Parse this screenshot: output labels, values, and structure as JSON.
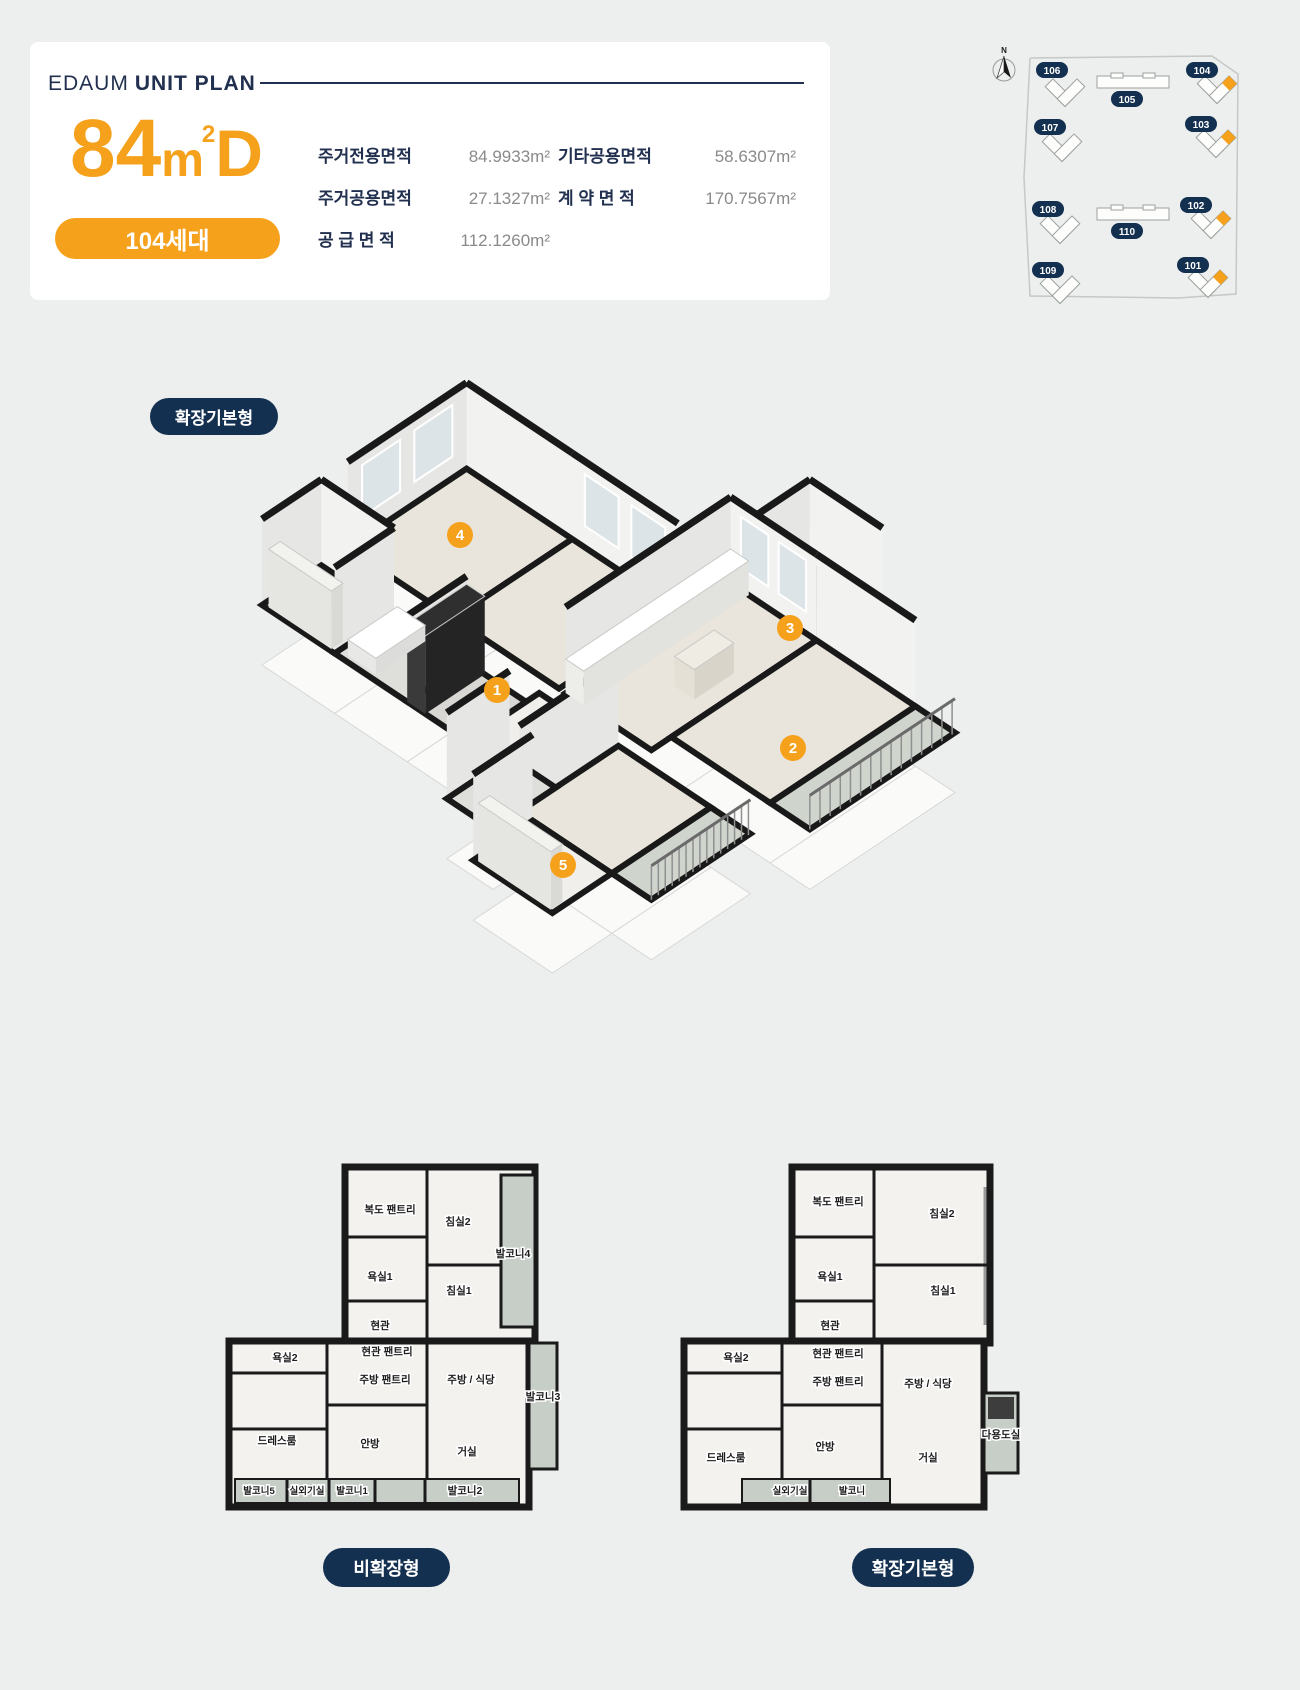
{
  "colors": {
    "orange": "#F5A11C",
    "navy": "#223050",
    "badge_navy": "#143050",
    "background": "#EDEFEE",
    "card": "#FFFFFF",
    "value_gray": "#8A8A8A",
    "wall_black": "#1A1A1A",
    "plan_floor": "#F3F2EF",
    "plan_balcony": "#C7CEC7"
  },
  "header": {
    "brand": "EDAUM",
    "title": "UNIT PLAN",
    "type_number": "84",
    "type_unit": "m",
    "type_sup": "2",
    "type_letter": "D",
    "units_badge": "104세대"
  },
  "specs": {
    "col1": [
      {
        "label": "주거전용면적",
        "value": "84.9933m²"
      },
      {
        "label": "주거공용면적",
        "value": "27.1327m²"
      },
      {
        "label": "공 급 면 적",
        "value": "112.1260m²"
      }
    ],
    "col2": [
      {
        "label": "기타공용면적",
        "value": "58.6307m²"
      },
      {
        "label": "계 약 면 적",
        "value": "170.7567m²"
      }
    ]
  },
  "site_map": {
    "north_label": "N",
    "highlighted_buildings": [
      "101",
      "102",
      "103",
      "104"
    ],
    "buildings": [
      {
        "id": "106",
        "type": "tower",
        "bx": 135,
        "by": 52,
        "lx": 122,
        "ly": 24,
        "hl": false
      },
      {
        "id": "105",
        "type": "slab",
        "bx": 203,
        "by": 36,
        "lx": 197,
        "ly": 53,
        "hl": false
      },
      {
        "id": "104",
        "type": "tower",
        "bx": 287,
        "by": 49,
        "lx": 272,
        "ly": 24,
        "hl": true
      },
      {
        "id": "107",
        "type": "tower",
        "bx": 132,
        "by": 107,
        "lx": 120,
        "ly": 81,
        "hl": false
      },
      {
        "id": "103",
        "type": "tower",
        "bx": 286,
        "by": 103,
        "lx": 271,
        "ly": 78,
        "hl": true
      },
      {
        "id": "108",
        "type": "tower",
        "bx": 130,
        "by": 189,
        "lx": 118,
        "ly": 163,
        "hl": false
      },
      {
        "id": "110",
        "type": "slab",
        "bx": 203,
        "by": 168,
        "lx": 197,
        "ly": 185,
        "hl": false
      },
      {
        "id": "102",
        "type": "tower",
        "bx": 281,
        "by": 184,
        "lx": 266,
        "ly": 159,
        "hl": true
      },
      {
        "id": "109",
        "type": "tower",
        "bx": 130,
        "by": 249,
        "lx": 118,
        "ly": 224,
        "hl": false
      },
      {
        "id": "101",
        "type": "tower",
        "bx": 278,
        "by": 243,
        "lx": 263,
        "ly": 219,
        "hl": true
      }
    ]
  },
  "iso": {
    "badge": "확장기본형",
    "cfg": {
      "x0": 17,
      "y0": 245,
      "w": 33,
      "h": 22,
      "wallH": 86,
      "platform": 60
    },
    "rooms": [
      {
        "id": "bedroom2",
        "u1": 2.6,
        "v1": 0,
        "u2": 6.2,
        "v2": 3.2,
        "fc": "#e9e5dc",
        "walls": "ne",
        "win": [
          "n"
        ]
      },
      {
        "id": "bedroom1",
        "u1": 2.6,
        "v1": 3.2,
        "u2": 6.2,
        "v2": 6.4,
        "fc": "#e9e5dc",
        "walls": "e",
        "win": [
          "e"
        ]
      },
      {
        "id": "pantry-hall",
        "u1": 0,
        "v1": 0,
        "u2": 1.8,
        "v2": 2.2,
        "fc": "#f0efeb",
        "walls": "ne"
      },
      {
        "id": "utility",
        "u1": 7.6,
        "v1": 7.4,
        "u2": 9.2,
        "v2": 9.6,
        "fc": "#4c4c4a",
        "walls": "ne"
      },
      {
        "id": "kitchen",
        "u1": 2.6,
        "v1": 6.6,
        "u2": 7.6,
        "v2": 9.2,
        "fc": "#e9e5dc",
        "walls": "ne",
        "win": [
          "e"
        ]
      },
      {
        "id": "bathroom1",
        "u1": 0,
        "v1": 2.2,
        "u2": 1.8,
        "v2": 4.4,
        "fc": "#dededb",
        "walls": "n"
      },
      {
        "id": "living",
        "u1": 3.2,
        "v1": 9.2,
        "u2": 7.6,
        "v2": 12.2,
        "fc": "#e9e5dc",
        "walls": "e"
      },
      {
        "id": "entry",
        "u1": 0,
        "v1": 4.4,
        "u2": 1.8,
        "v2": 6.2,
        "fc": "#d9d7d3",
        "walls": "n"
      },
      {
        "id": "hallway",
        "u1": 0.3,
        "v1": 6.2,
        "u2": 2.2,
        "v2": 8.4,
        "fc": "#f0efeb",
        "walls": ""
      },
      {
        "id": "balcony",
        "u1": 3.2,
        "v1": 12.2,
        "u2": 7.6,
        "v2": 13.4,
        "fc": "#cfd4cd",
        "walls": "",
        "rail": true
      },
      {
        "id": "master",
        "u1": -0.8,
        "v1": 8.6,
        "u2": 2.2,
        "v2": 11.4,
        "fc": "#e9e5dc",
        "walls": "n"
      },
      {
        "id": "bathroom2",
        "u1": -1.6,
        "v1": 7.2,
        "u2": 0.3,
        "v2": 8.6,
        "fc": "#dededb",
        "walls": "n"
      },
      {
        "id": "outdoor-unit",
        "u1": -0.8,
        "v1": 11.4,
        "u2": 2.2,
        "v2": 12.6,
        "fc": "#cfd4cd",
        "walls": "",
        "rail": true
      },
      {
        "id": "dressroom",
        "u1": -2.6,
        "v1": 9,
        "u2": -0.8,
        "v2": 11.4,
        "fc": "#f0efeb",
        "walls": "n"
      }
    ],
    "boxes": [
      {
        "u1": 0,
        "v1": 4.4,
        "u2": 1.8,
        "v2": 4.95,
        "h": 78,
        "f": "#2f2f2f",
        "s1": "#242424",
        "s2": "#3a3a3a"
      },
      {
        "u1": 2.6,
        "v1": 6.6,
        "u2": 7.6,
        "v2": 7.15,
        "h": 34,
        "f": "#ffffff",
        "s1": "#e2e2df",
        "s2": "#ededea"
      },
      {
        "u1": 4.4,
        "v1": 8.1,
        "u2": 5.6,
        "v2": 8.7,
        "h": 30,
        "f": "#efece4",
        "s1": "#d8d4c9",
        "s2": "#e4e0d6"
      },
      {
        "u1": 0.15,
        "v1": 2.45,
        "u2": 1.65,
        "v2": 3.3,
        "h": 16,
        "f": "#ffffff",
        "s1": "#dcdcda",
        "s2": "#e8e8e6"
      },
      {
        "u1": 0.05,
        "v1": 0.15,
        "u2": 0.4,
        "v2": 2.05,
        "h": 58,
        "f": "#f2f2ef",
        "s1": "#d9d9d6",
        "s2": "#e5e5e2"
      },
      {
        "u1": -2.55,
        "v1": 9.1,
        "u2": -2.2,
        "v2": 11.3,
        "h": 58,
        "f": "#f2f2ef",
        "s1": "#d9d9d6",
        "s2": "#e5e5e2"
      }
    ],
    "markers": [
      {
        "n": "1",
        "x": 252,
        "y": 330
      },
      {
        "n": "2",
        "x": 548,
        "y": 388
      },
      {
        "n": "3",
        "x": 545,
        "y": 268
      },
      {
        "n": "4",
        "x": 215,
        "y": 175
      },
      {
        "n": "5",
        "x": 318,
        "y": 505
      }
    ]
  },
  "plans": [
    {
      "name": "비확장형",
      "labels": [
        {
          "t": "복도 팬트리",
          "x": 165,
          "y": 118
        },
        {
          "t": "침실2",
          "x": 233,
          "y": 130
        },
        {
          "t": "발코니4",
          "x": 288,
          "y": 162
        },
        {
          "t": "욕실1",
          "x": 155,
          "y": 185
        },
        {
          "t": "침실1",
          "x": 234,
          "y": 199
        },
        {
          "t": "현관",
          "x": 155,
          "y": 234
        },
        {
          "t": "현관 팬트리",
          "x": 162,
          "y": 260
        },
        {
          "t": "욕실2",
          "x": 60,
          "y": 266
        },
        {
          "t": "주방 팬트리",
          "x": 160,
          "y": 288
        },
        {
          "t": "주방 / 식당",
          "x": 246,
          "y": 288
        },
        {
          "t": "발코니3",
          "x": 318,
          "y": 305
        },
        {
          "t": "드레스룸",
          "x": 52,
          "y": 349
        },
        {
          "t": "안방",
          "x": 145,
          "y": 352
        },
        {
          "t": "거실",
          "x": 242,
          "y": 360
        },
        {
          "t": "발코니5",
          "x": 34,
          "y": 399,
          "s": 9.5
        },
        {
          "t": "실외기실",
          "x": 82,
          "y": 399,
          "s": 9.5
        },
        {
          "t": "발코니1",
          "x": 127,
          "y": 399,
          "s": 9.5
        },
        {
          "t": "발코니2",
          "x": 240,
          "y": 399
        }
      ]
    },
    {
      "name": "확장기본형",
      "labels": [
        {
          "t": "복도 팬트리",
          "x": 158,
          "y": 110
        },
        {
          "t": "침실2",
          "x": 262,
          "y": 122
        },
        {
          "t": "욕실1",
          "x": 150,
          "y": 185
        },
        {
          "t": "침실1",
          "x": 263,
          "y": 199
        },
        {
          "t": "현관",
          "x": 150,
          "y": 234
        },
        {
          "t": "현관 팬트리",
          "x": 158,
          "y": 262
        },
        {
          "t": "욕실2",
          "x": 56,
          "y": 266
        },
        {
          "t": "주방 팬트리",
          "x": 158,
          "y": 290
        },
        {
          "t": "주방 / 식당",
          "x": 248,
          "y": 292
        },
        {
          "t": "드레스룸",
          "x": 46,
          "y": 366
        },
        {
          "t": "안방",
          "x": 145,
          "y": 355
        },
        {
          "t": "거실",
          "x": 248,
          "y": 366
        },
        {
          "t": "실외기실",
          "x": 110,
          "y": 399,
          "s": 9.5
        },
        {
          "t": "발코니",
          "x": 172,
          "y": 399,
          "s": 9.5
        },
        {
          "t": "다용도실",
          "x": 321,
          "y": 343
        }
      ]
    }
  ]
}
